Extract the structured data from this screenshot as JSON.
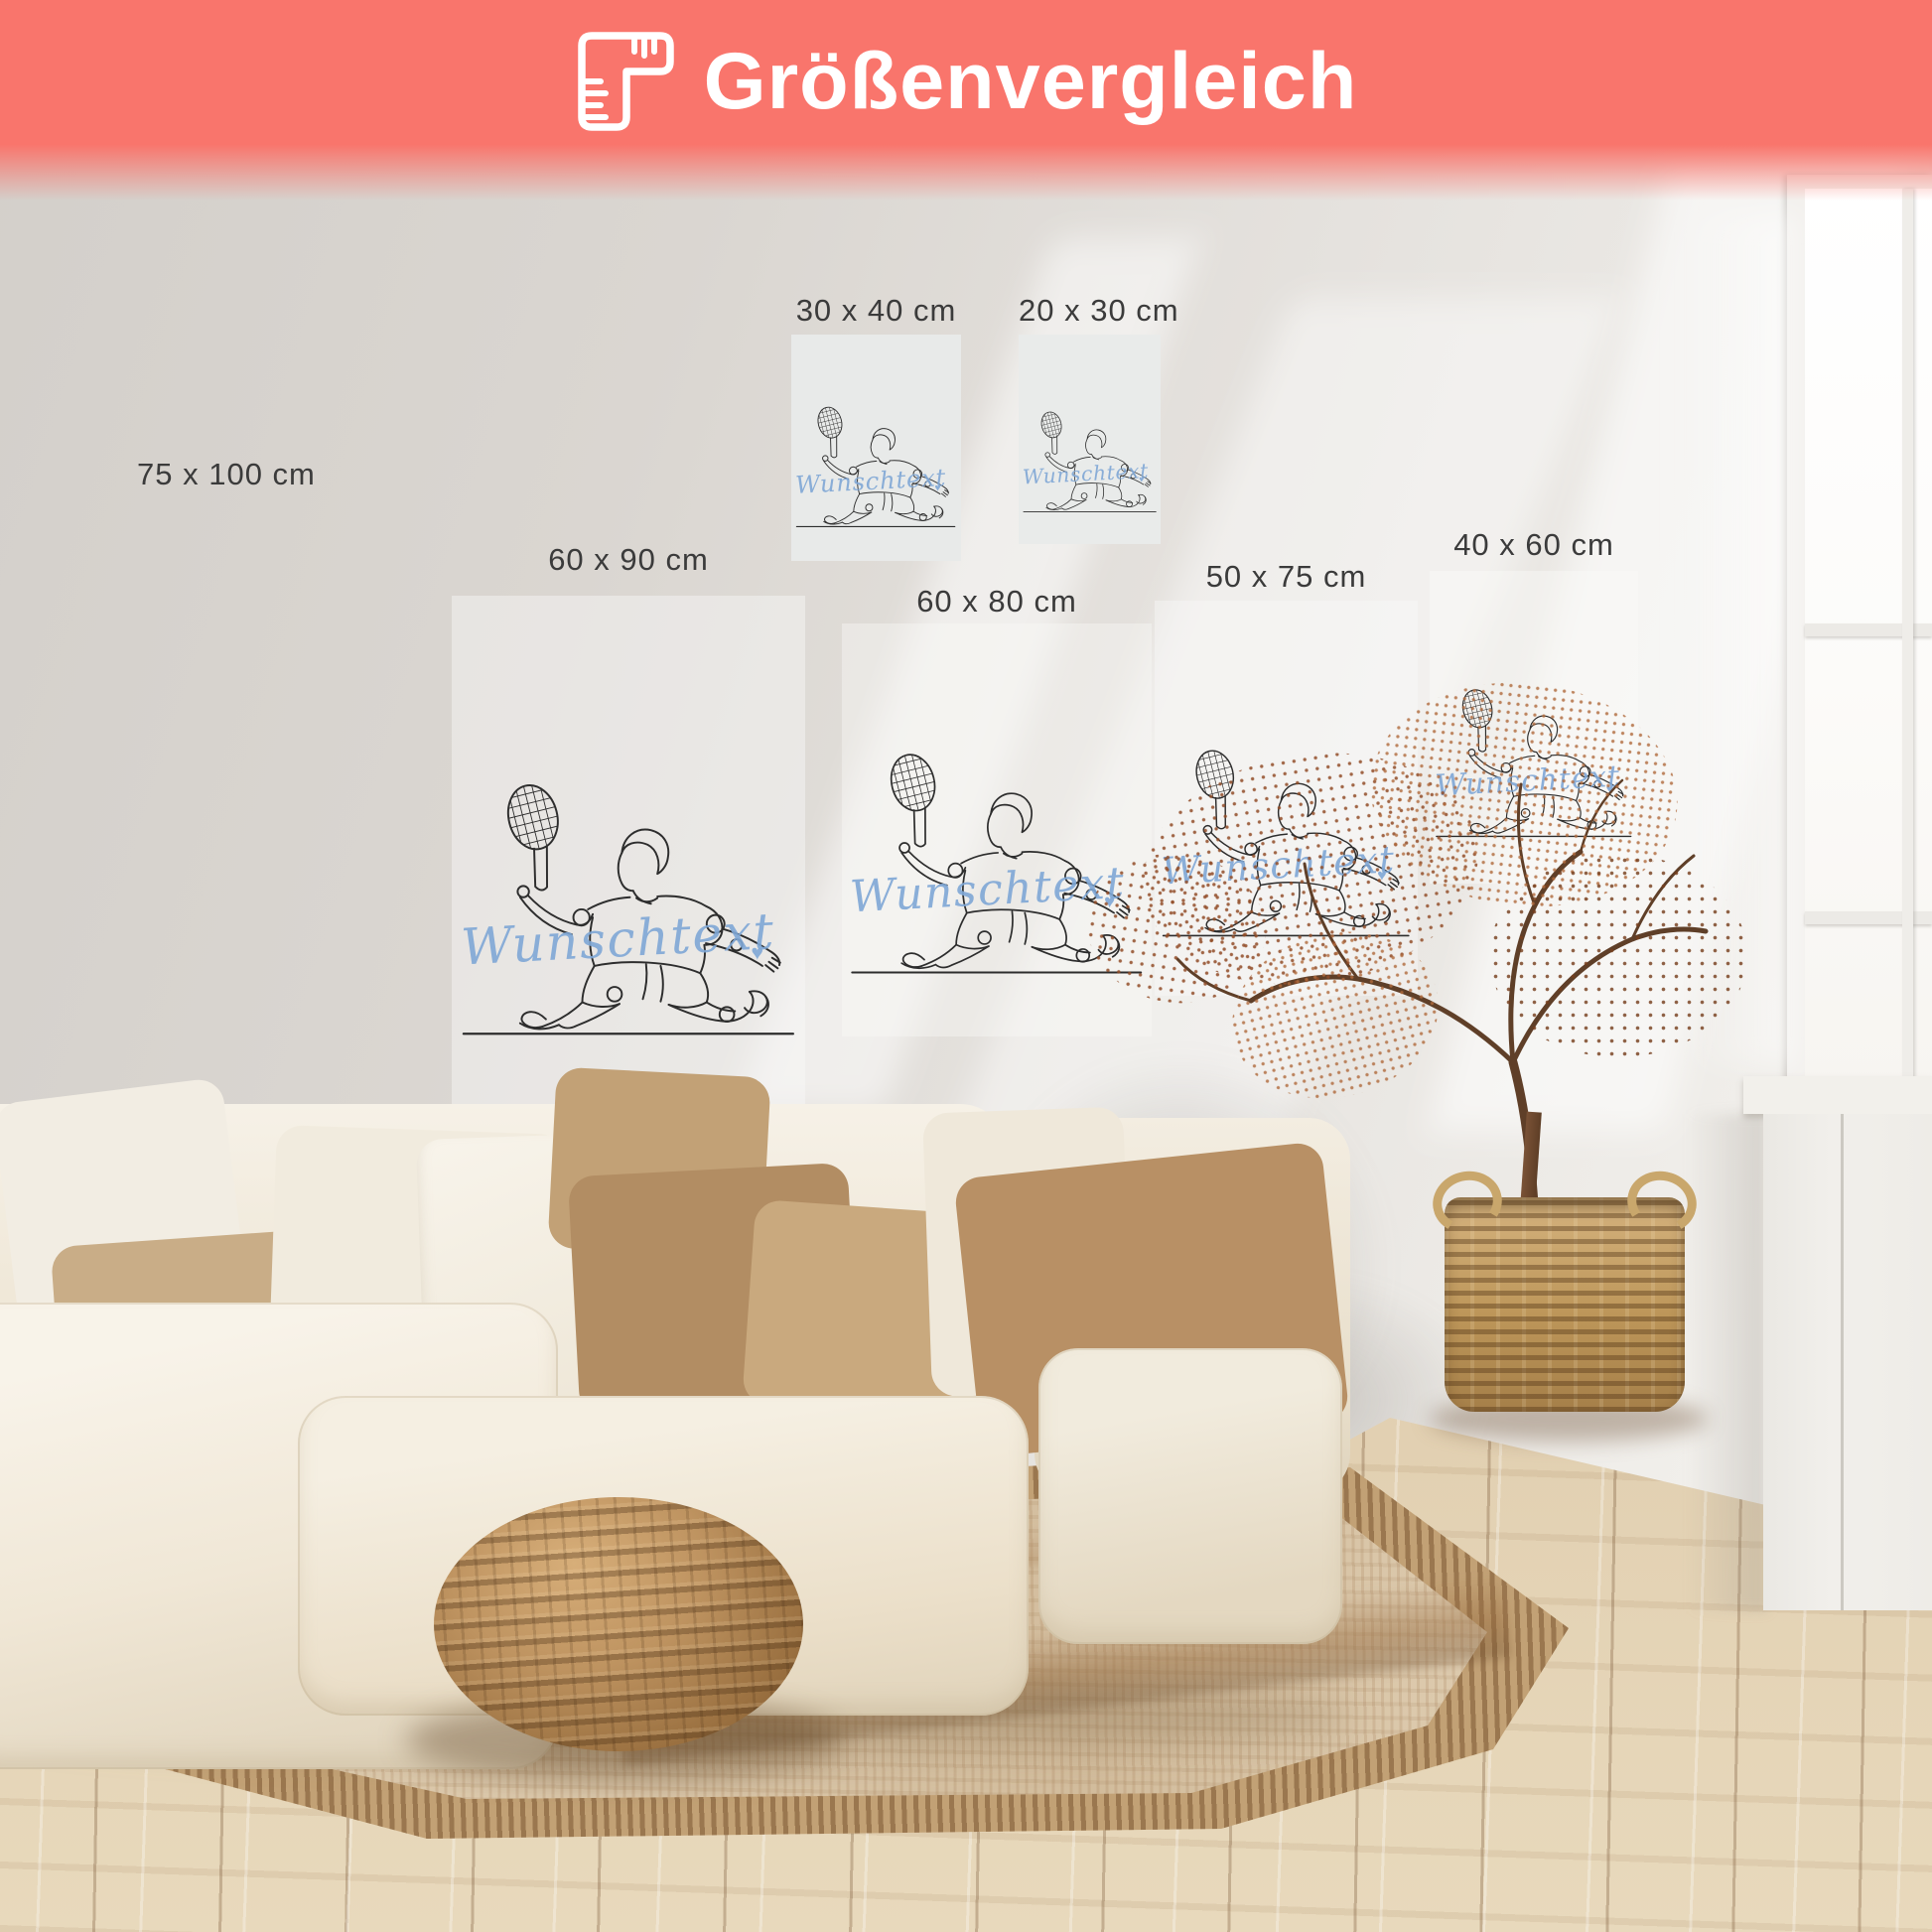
{
  "banner": {
    "title": "Größenvergleich",
    "icon": "ruler-icon",
    "background_color": "#F9756C",
    "text_color": "#FFFFFF"
  },
  "posters": [
    {
      "id": "75x100",
      "label": "75 x 100 cm"
    },
    {
      "id": "30x40",
      "label": "30 x 40 cm"
    },
    {
      "id": "20x30",
      "label": "20 x 30 cm"
    },
    {
      "id": "60x90",
      "label": "60 x 90 cm"
    },
    {
      "id": "60x80",
      "label": "60 x 80 cm"
    },
    {
      "id": "50x75",
      "label": "50 x 75 cm"
    },
    {
      "id": "40x60",
      "label": "40 x 60 cm"
    }
  ],
  "artwork": {
    "subject": "tennis-player-single-line-drawing",
    "custom_text": "Wunschtext",
    "heart_symbol": "♥",
    "script_color": "#7FA7D6",
    "line_color": "#2D2D2D"
  },
  "scene": {
    "wall_color": "#E2DEDA",
    "floor_color": "#D8C3A5",
    "rug_color": "#D9C6AA",
    "sofa_color": "#F2ECE0",
    "pouf_color": "#B58B58",
    "basket_color": "#C2A06A",
    "plant_color": "#9A5531"
  }
}
